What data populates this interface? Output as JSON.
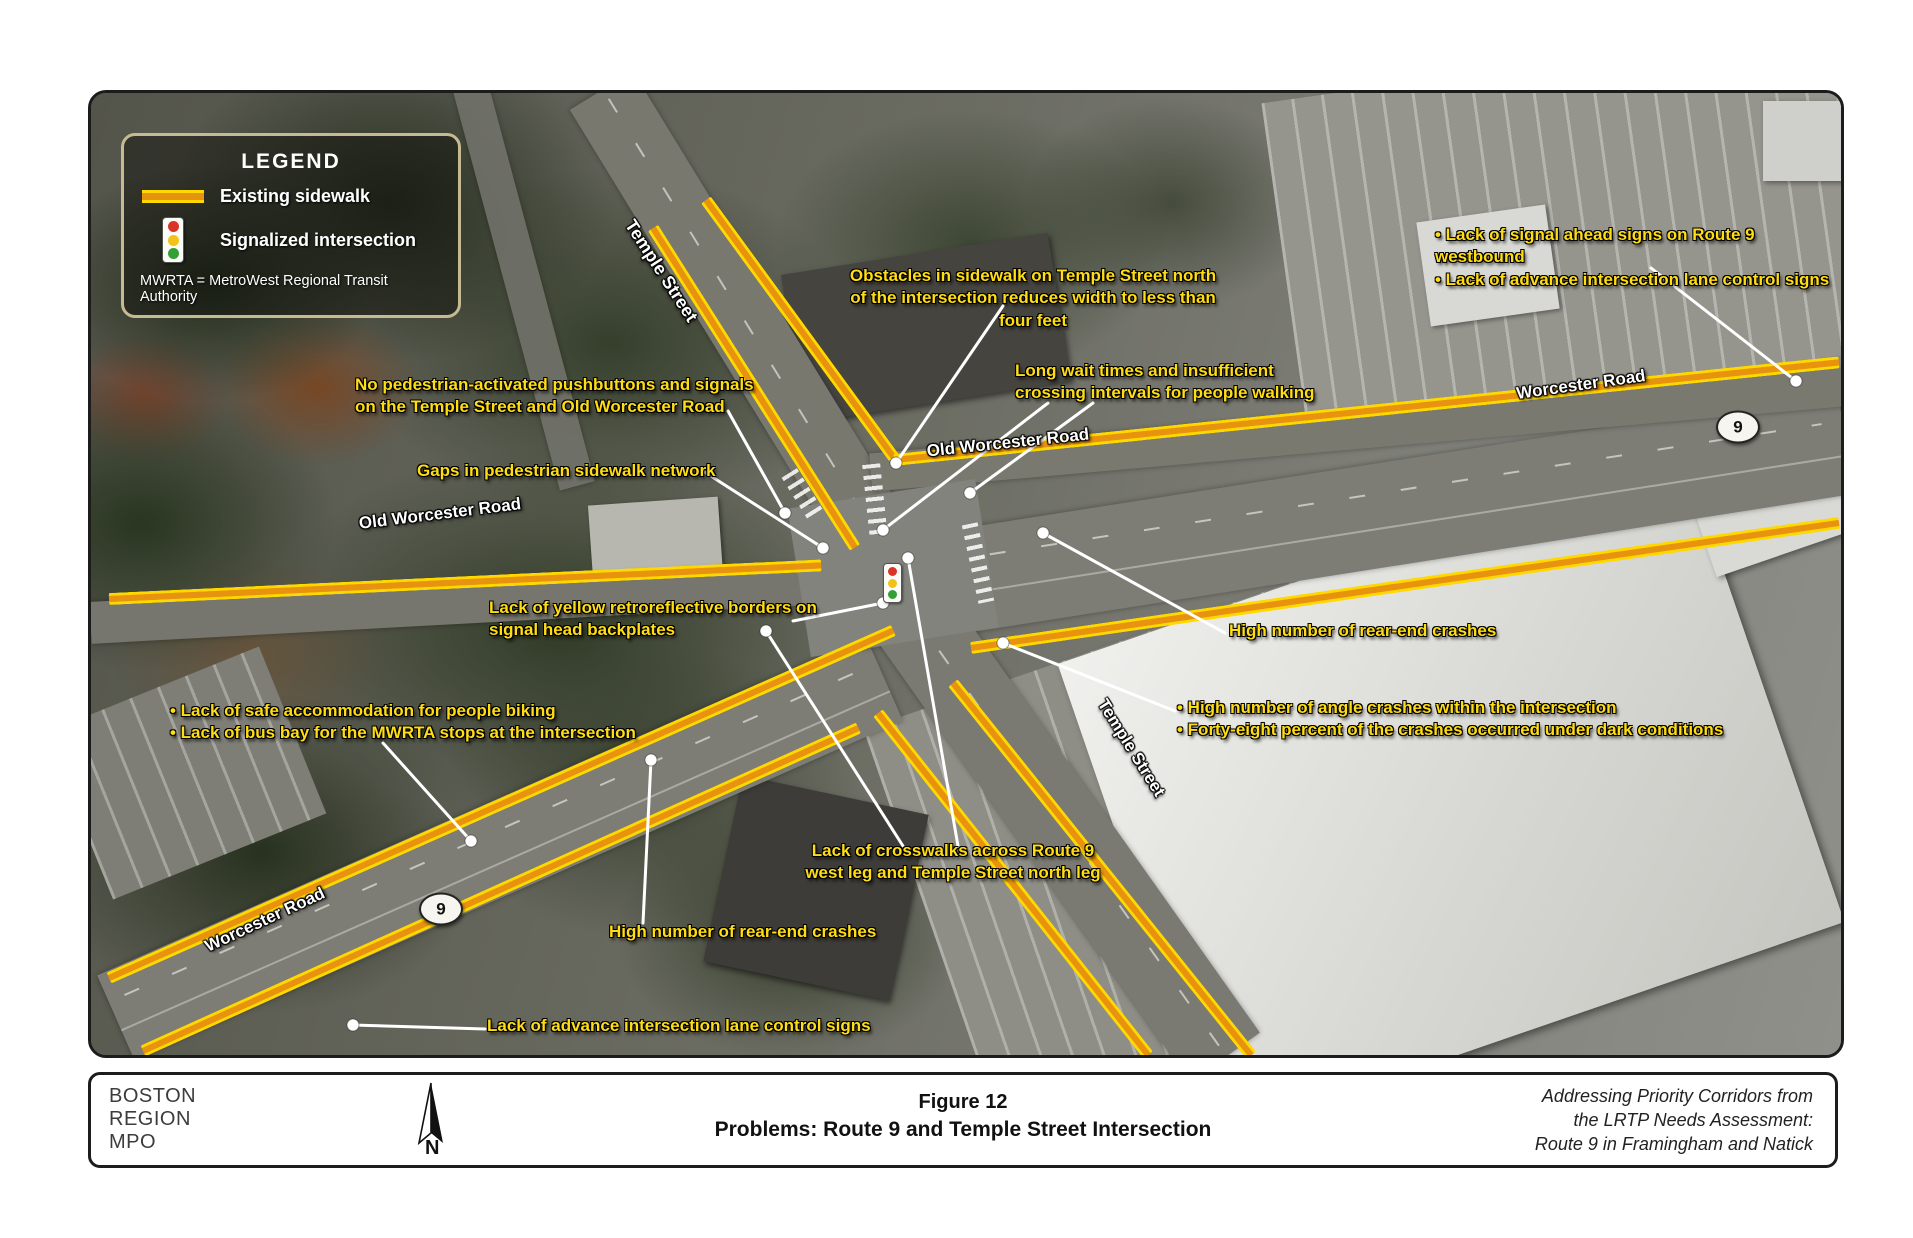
{
  "legend": {
    "title": "LEGEND",
    "items": [
      {
        "symbol": "sidewalk-line-icon",
        "label": "Existing sidewalk"
      },
      {
        "symbol": "traffic-signal-icon",
        "label": "Signalized intersection"
      }
    ],
    "note": "MWRTA = MetroWest Regional Transit Authority"
  },
  "annotations": [
    {
      "id": "signal-ahead-signs",
      "text": "• Lack of signal ahead signs on Route 9 westbound\n• Lack of advance intersection lane control signs"
    },
    {
      "id": "obstacles-sidewalk",
      "text": "Obstacles in sidewalk on Temple Street north\nof the intersection reduces width to less than four feet"
    },
    {
      "id": "long-wait-times",
      "text": "Long wait times and insufficient\ncrossing intervals for people walking"
    },
    {
      "id": "no-pushbuttons",
      "text": "No pedestrian-activated pushbuttons and signals\non the Temple Street and Old Worcester Road"
    },
    {
      "id": "sidewalk-gaps",
      "text": "Gaps in pedestrian sidewalk network"
    },
    {
      "id": "retroreflective-borders",
      "text": "Lack of yellow retroreflective borders on\nsignal head backplates"
    },
    {
      "id": "biking-bus-bay",
      "text": "• Lack of safe accommodation for people biking\n• Lack of bus bay for the MWRTA stops at the intersection"
    },
    {
      "id": "rear-end-crashes-east",
      "text": "High number of rear-end crashes"
    },
    {
      "id": "angle-crashes",
      "text": "• High number of angle crashes within the intersection\n• Forty-eight percent of the crashes occurred under dark conditions"
    },
    {
      "id": "crosswalk-gaps",
      "text": "Lack of crosswalks across Route 9\nwest leg and Temple Street north leg"
    },
    {
      "id": "rear-end-crashes-west",
      "text": "High number of rear-end crashes"
    },
    {
      "id": "advance-lane-signs",
      "text": "Lack of advance intersection lane control signs"
    }
  ],
  "road_labels": [
    {
      "id": "temple-street-north",
      "text": "Temple Street"
    },
    {
      "id": "old-worcester-road-west",
      "text": "Old Worcester Road"
    },
    {
      "id": "old-worcester-road-east",
      "text": "Old Worcester Road"
    },
    {
      "id": "worcester-road-east",
      "text": "Worcester Road"
    },
    {
      "id": "worcester-road-west",
      "text": "Worcester Road"
    },
    {
      "id": "temple-street-south",
      "text": "Temple Street"
    }
  ],
  "shields": [
    {
      "label": "9"
    },
    {
      "label": "9"
    }
  ],
  "footer": {
    "agency": "BOSTON\nREGION\nMPO",
    "north_label": "N",
    "figure_number": "Figure 12",
    "figure_title": "Problems: Route 9 and Temple Street Intersection",
    "source_note": "Addressing Priority Corridors from\nthe LRTP Needs Assessment:\nRoute 9 in Framingham and Natick"
  },
  "colors": {
    "annotation_yellow": "#ffdd15",
    "sidewalk_core": "#e8930f",
    "sidewalk_edge": "#ffd800",
    "legend_border": "#c6ba92"
  }
}
